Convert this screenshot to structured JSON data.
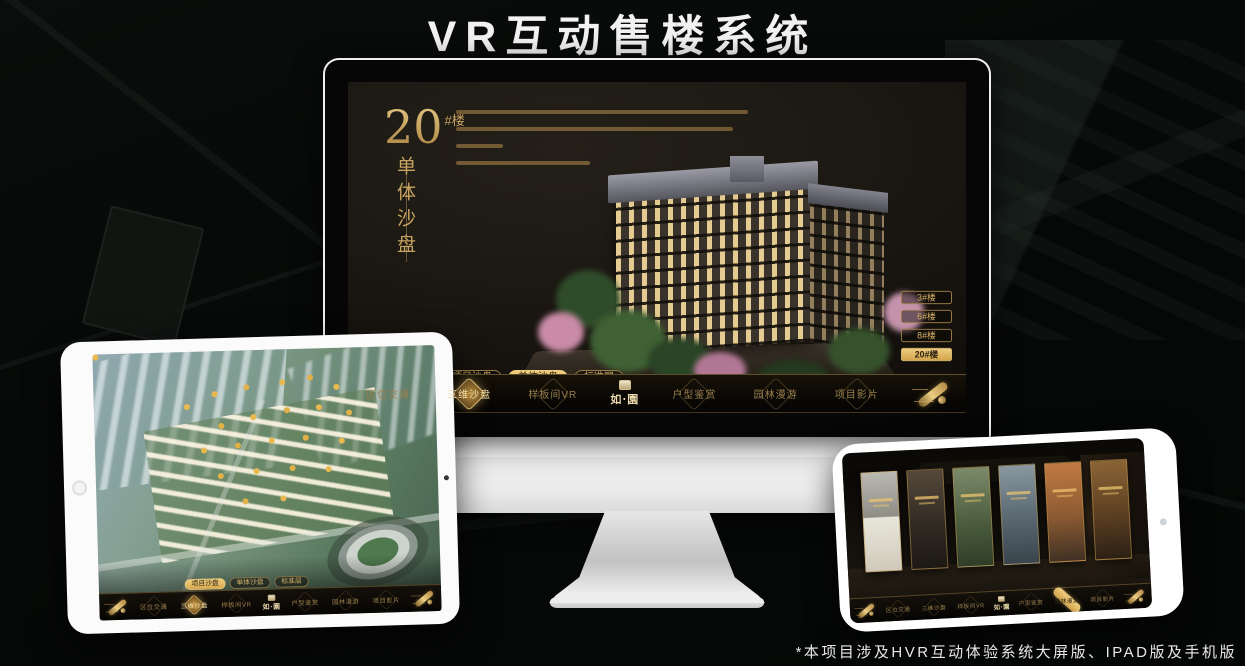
{
  "page": {
    "title": "VR互动售楼系统",
    "footnote": "*本项目涉及HVR互动体验系统大屏版、IPAD版及手机版"
  },
  "colors": {
    "gold": "#c9a361",
    "gold_bright": "#eecd7f",
    "screen_background": "#17120c",
    "background": "#070908"
  },
  "app_nav": {
    "logo_seal_icon": "seal-icon",
    "logo_text": "如·園",
    "items": [
      "区位交通",
      "三维沙盘",
      "样板间VR",
      "户型鉴赏",
      "园林漫游",
      "项目影片"
    ],
    "scroll_icon": "scroll-icon"
  },
  "monitor_screen": {
    "building_number": "20",
    "building_unit": "#楼",
    "subtitle_vertical": "单体沙盘",
    "floor_buttons": [
      "3#楼",
      "6#楼",
      "8#楼",
      "20#楼"
    ],
    "active_floor_button": "20#楼",
    "sub_tabs": [
      "项目沙盘",
      "单体沙盘",
      "标准层"
    ],
    "active_sub_tab": "单体沙盘",
    "active_nav_item": "三维沙盘"
  },
  "tablet_screen": {
    "sub_tabs": [
      "项目沙盘",
      "单体沙盘",
      "标准层"
    ],
    "active_sub_tab": "项目沙盘",
    "active_nav_item": "三维沙盘"
  },
  "phone_screen": {
    "active_nav_item": "园林漫游",
    "gallery_panel_count": "6"
  }
}
